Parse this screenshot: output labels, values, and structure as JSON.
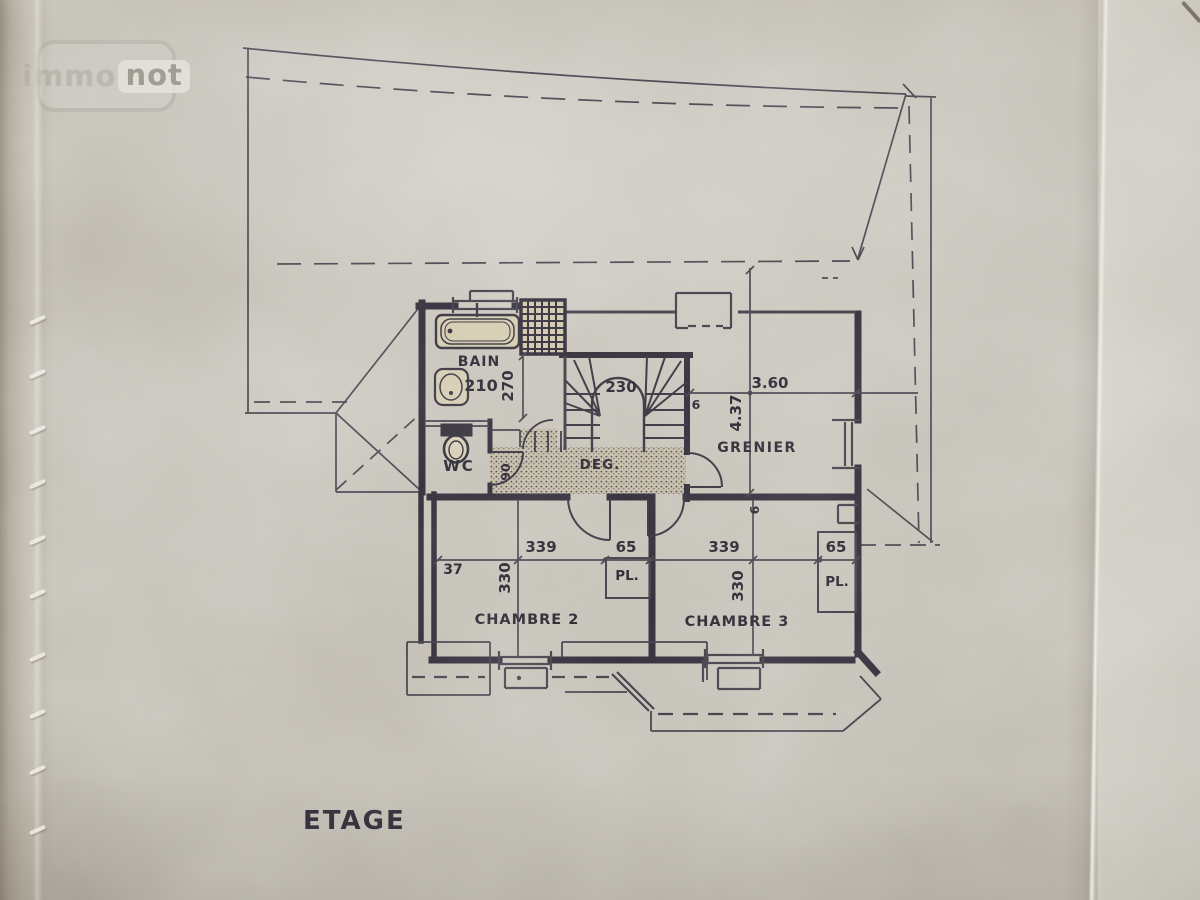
{
  "photo": {
    "watermark": {
      "brand_left": "immo",
      "brand_right": "not"
    }
  },
  "plan": {
    "floor_label": "ETAGE",
    "rooms": {
      "bain": "BAIN",
      "wc": "WC",
      "deg": "DEG.",
      "grenier": "GRENIER",
      "chambre2": "CHAMBRE 2",
      "chambre3": "CHAMBRE 3",
      "placard2": "PL.",
      "placard3": "PL."
    },
    "dimensions": {
      "bain_width": "210",
      "bain_depth": "270",
      "wc_door_width": "90",
      "stair_width": "230",
      "stair_wall_thickness": "6",
      "grenier_width_m": "3.60",
      "grenier_depth_m": "4.37",
      "partition_thickness": "6",
      "chambre2_width": "339",
      "chambre2_depth": "330",
      "placard2_width": "65",
      "left_offset": "37",
      "chambre3_width": "339",
      "chambre3_depth": "330",
      "placard3_width": "65"
    }
  },
  "colors": {
    "paper": "#c6c2b9",
    "ink_thick": "#322e39",
    "ink": "#433f49",
    "ink_thin": "#4b4752",
    "fixture_fill": "#d3caaf"
  }
}
